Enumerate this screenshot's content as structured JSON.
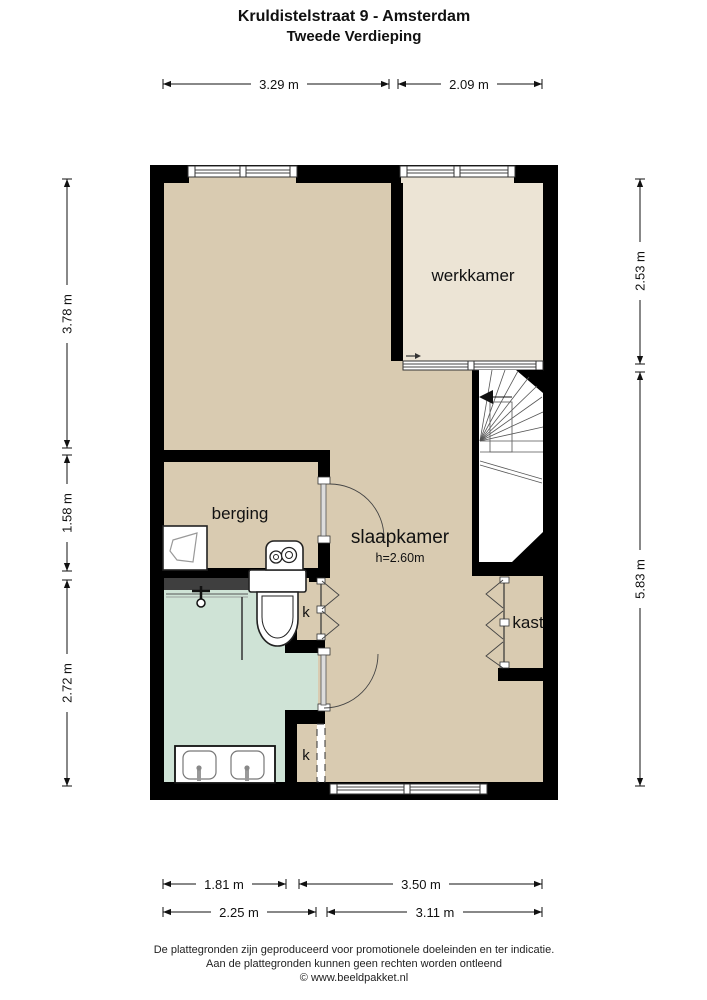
{
  "title": {
    "line1": "Kruldistelstraat 9 - Amsterdam",
    "line2": "Tweede Verdieping"
  },
  "rooms": {
    "werkkamer": "werkkamer",
    "slaapkamer": "slaapkamer",
    "slaapkamer_height": "h=2.60m",
    "berging": "berging",
    "kast": "kast",
    "k_top": "k",
    "k_bottom": "k"
  },
  "dimensions": {
    "top": [
      "3.29 m",
      "2.09 m"
    ],
    "left": [
      "3.78 m",
      "1.58 m",
      "2.72 m"
    ],
    "right": [
      "2.53 m",
      "5.83 m"
    ],
    "bottom_outer": [
      "1.81 m",
      "3.50 m"
    ],
    "bottom_inner": [
      "2.25 m",
      "3.11 m"
    ]
  },
  "footer": [
    "De plattegronden zijn geproduceerd voor promotionele doeleinden en ter indicatie.",
    "Aan de plattegronden kunnen geen rechten worden ontleend",
    "© www.beeldpakket.nl"
  ],
  "colors": {
    "wall": "#000000",
    "floor_main": "#d9cbb1",
    "floor_werkkamer": "#ece4d5",
    "floor_bath": "#cfe3d6",
    "shower_screen": "#3f3f3f"
  }
}
